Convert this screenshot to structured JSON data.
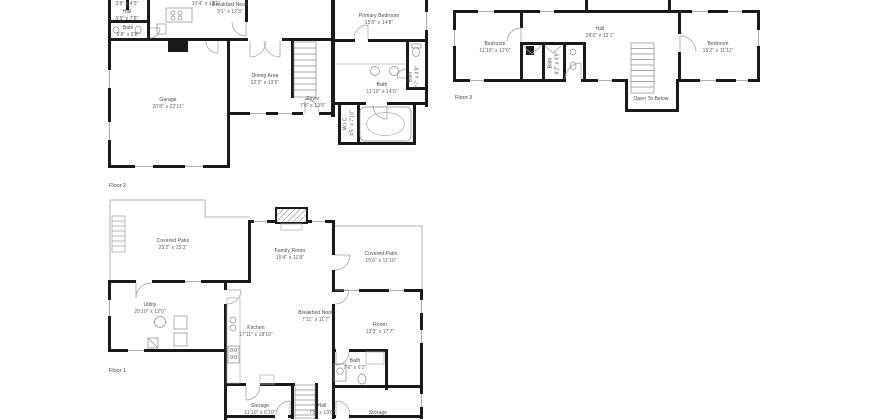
{
  "floor2": {
    "caption": "Floor 2",
    "rooms": {
      "closet": {
        "name": "",
        "dims": "3'8\" x 4'5\""
      },
      "hall": {
        "name": "Hall",
        "dims": "5'5\" x 7'8\""
      },
      "bath_small": {
        "name": "Bath",
        "dims": "5'8\" x 2'8\""
      },
      "kitchen": {
        "name": "",
        "dims": "10'4\" x 13'1\""
      },
      "breakfast_nook": {
        "name": "Breakfast Nook",
        "dims": "9'1\" x 12'3\""
      },
      "primary_bedroom": {
        "name": "Primary Bedroom",
        "dims": "15'0\" x 14'8\""
      },
      "dining_area": {
        "name": "Dining Area",
        "dims": "12'2\" x 13'5\""
      },
      "garage": {
        "name": "Garage",
        "dims": "20'8\" x 22'11\""
      },
      "foyer": {
        "name": "Foyer",
        "dims": "7'8\" x 13'5\""
      },
      "bath_primary": {
        "name": "Bath",
        "dims": "11'10\" x 14'0\""
      },
      "bath_toilet": {
        "name": "Bath",
        "dims": "2'7\" x 4'9\""
      },
      "wic": {
        "name": "W.I.C.",
        "dims": "4'5\" x 7'10\""
      }
    }
  },
  "floor3": {
    "caption": "Floor 3",
    "rooms": {
      "bedroom_left": {
        "name": "Bedroom",
        "dims": "11'10\" x 12'0\""
      },
      "hall": {
        "name": "Hall",
        "dims": "28'0\" x 12'1\""
      },
      "bedroom_right": {
        "name": "Bedroom",
        "dims": "15'2\" x 11'11\""
      },
      "bath": {
        "name": "Bath",
        "dims": "8'2\" x 4'9\""
      },
      "open_to_below": {
        "name": "Open To Below",
        "dims": ""
      }
    }
  },
  "floor1": {
    "caption": "Floor 1",
    "rooms": {
      "covered_patio_left": {
        "name": "Covered Patio",
        "dims": "25'2\" x 15'3\""
      },
      "family_room": {
        "name": "Family Room",
        "dims": "15'4\" x 11'8\""
      },
      "covered_patio_right": {
        "name": "Covered Patio",
        "dims": "15'6\" x 11'10\""
      },
      "utility": {
        "name": "Utility",
        "dims": "20'10\" x 12'0\""
      },
      "kitchen": {
        "name": "Kitchen",
        "dims": "17'11\" x 18'10\""
      },
      "breakfast_nook": {
        "name": "Breakfast Nook",
        "dims": "7'11\" x 11'7\""
      },
      "room": {
        "name": "Room",
        "dims": "13'3\" x 17'7\""
      },
      "bath": {
        "name": "Bath",
        "dims": "7'6\" x 6'2\""
      },
      "storage_left": {
        "name": "Storage",
        "dims": "11'10\" x 6'10\""
      },
      "hall": {
        "name": "Hall",
        "dims": "7'8\" x 13'6\""
      },
      "storage_right": {
        "name": "Storage",
        "dims": ""
      }
    }
  },
  "colors": {
    "wall": "#1a1a1a",
    "fixture": "#8a8a8a",
    "patio_line": "#b0b0b0",
    "label_text": "#4f4f4f"
  }
}
